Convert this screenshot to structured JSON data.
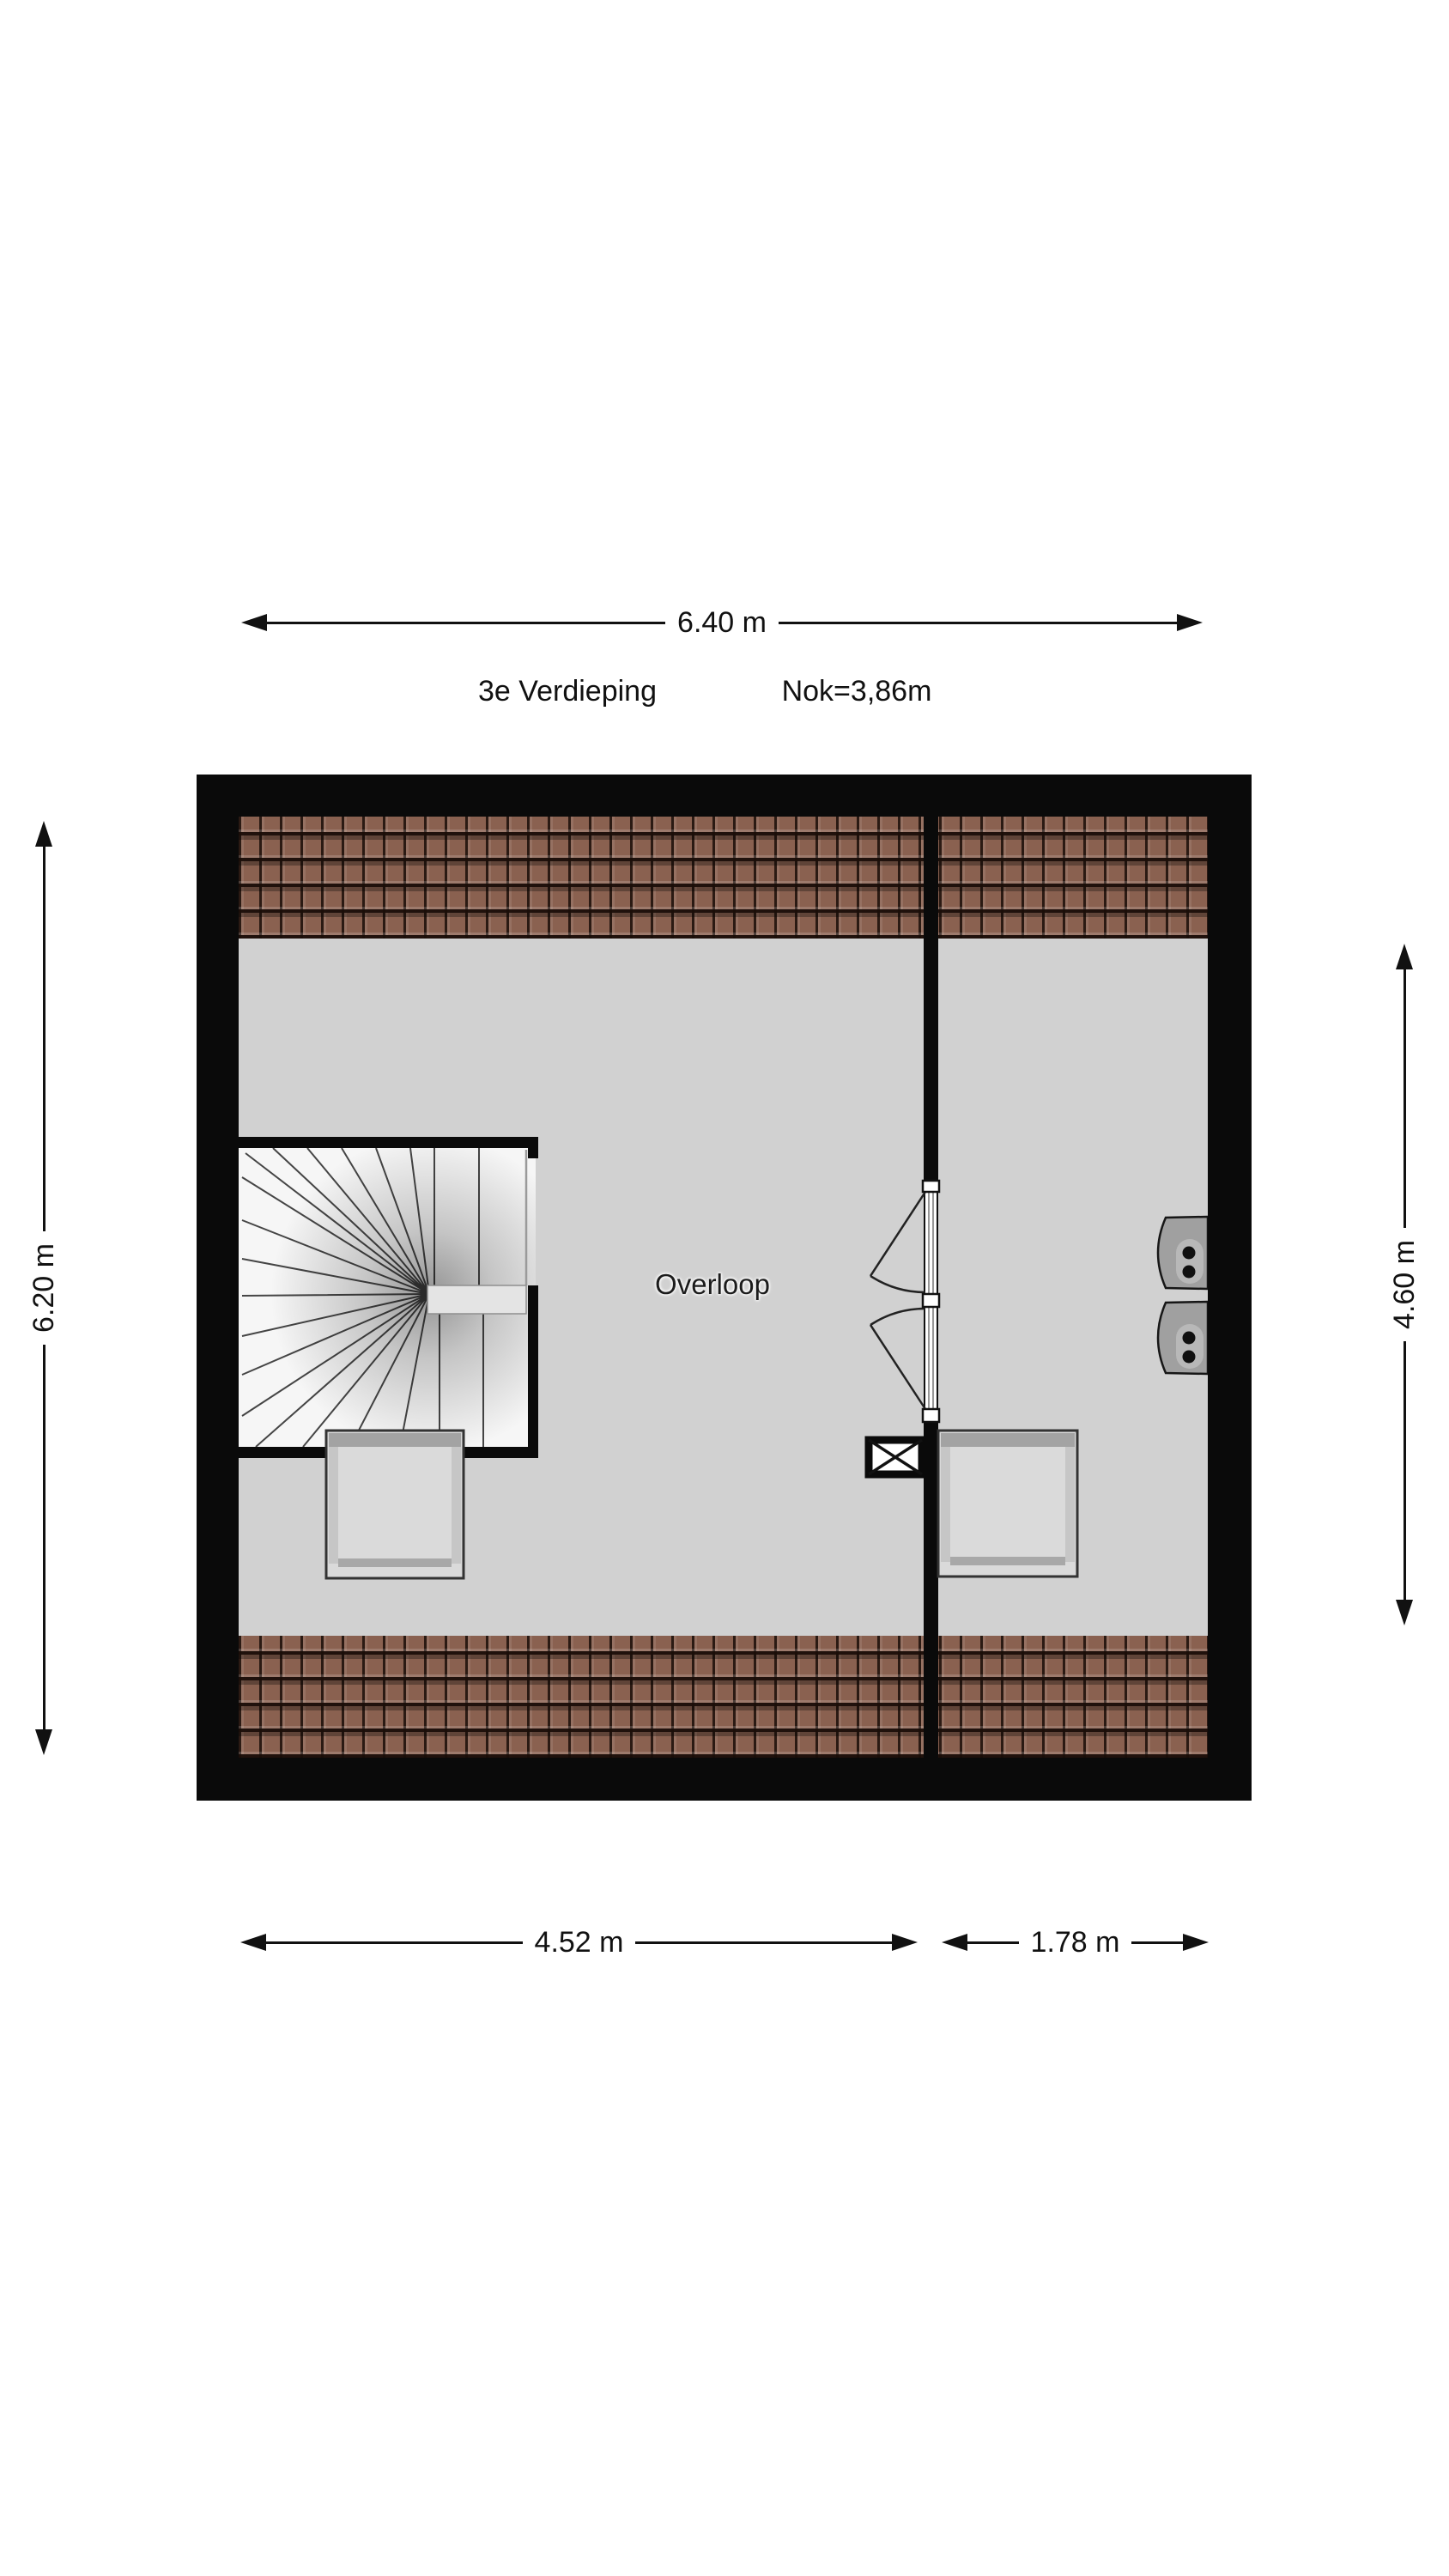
{
  "header": {
    "floor_label": "3e Verdieping",
    "ridge_label": "Nok=3,86m"
  },
  "dimensions": {
    "top": "6.40 m",
    "left": "6.20 m",
    "right": "4.60 m",
    "bottom_left": "4.52 m",
    "bottom_right": "1.78 m"
  },
  "rooms": [
    {
      "name": "Overloop"
    }
  ],
  "colors": {
    "page_bg": "#ffffff",
    "wall": "#0a0a0a",
    "floor": "#d1d1d1",
    "roof_tile": "#8a6150",
    "roof_tile_joint": "#1f1209",
    "stair_tread": "#f6f6f6",
    "skylight": "#dadada",
    "appliance": "#a0a0a0",
    "dimension_line": "#111111"
  }
}
